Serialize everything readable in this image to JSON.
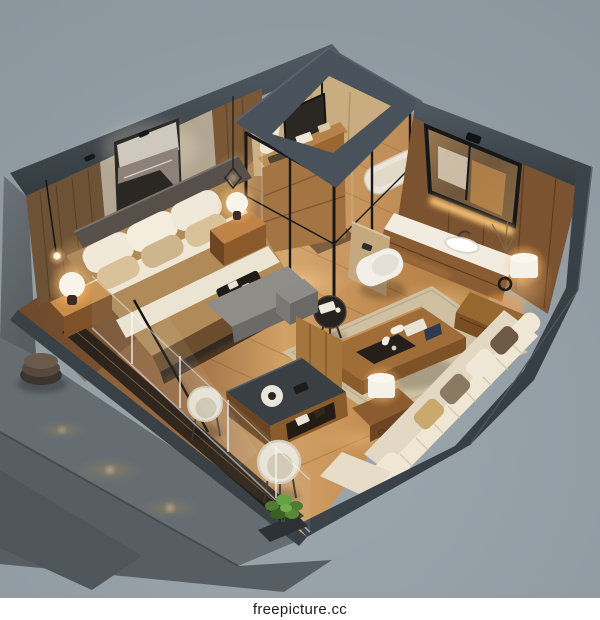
{
  "meta": {
    "alt": "Isometric 3D cutaway render of a studio apartment: bedroom with art and bed, glass-walled bathroom with skylight, wood vanity wall with mirror and sink, living area with sofa and coffee table, concrete terrace platform outside a glass railing"
  },
  "watermark": {
    "text": "freepicture.cc"
  },
  "palette": {
    "bg": "#95a0a7",
    "wallBand": "#49515a",
    "wallBandDark": "#31383e",
    "woodFloorLight": "#d2a166",
    "woodFloorDark": "#83552f",
    "concrete": "#656c71",
    "concreteDark": "#545b60",
    "glowWarm": "#ffb763",
    "cream": "#e9dfcc",
    "rug": "#cfc0a2",
    "watermarkBg": "#ffffff",
    "watermarkText": "#1c1c1c"
  },
  "scene": {
    "rooms": [
      {
        "name": "bedroom",
        "furniture": [
          "platform bed",
          "headboard",
          "seascape artwork",
          "nightstand left",
          "nightstand right",
          "dome table lamps",
          "pendant light",
          "gray bench",
          "floor lamp cord"
        ]
      },
      {
        "name": "bathroom",
        "furniture": [
          "black-framed glass enclosure",
          "open skylight roof",
          "dresser with decor",
          "hanging towels",
          "bathtub",
          "wall-hung toilet"
        ]
      },
      {
        "name": "vanity",
        "furniture": [
          "framed mirror",
          "stone sink counter",
          "under-mirror light",
          "drum lamp",
          "ring decor",
          "side cabinet"
        ]
      },
      {
        "name": "living-area",
        "furniture": [
          "channel-tufted sofa",
          "throw pillows",
          "wood coffee table",
          "decor tray",
          "round side table",
          "desk console",
          "barrel chairs",
          "gray ottoman",
          "area rug",
          "drum lamp table"
        ]
      },
      {
        "name": "terrace",
        "furniture": [
          "concrete platform",
          "stone ottoman",
          "recessed floor lights",
          "planter with plant",
          "glass railing"
        ]
      }
    ]
  }
}
